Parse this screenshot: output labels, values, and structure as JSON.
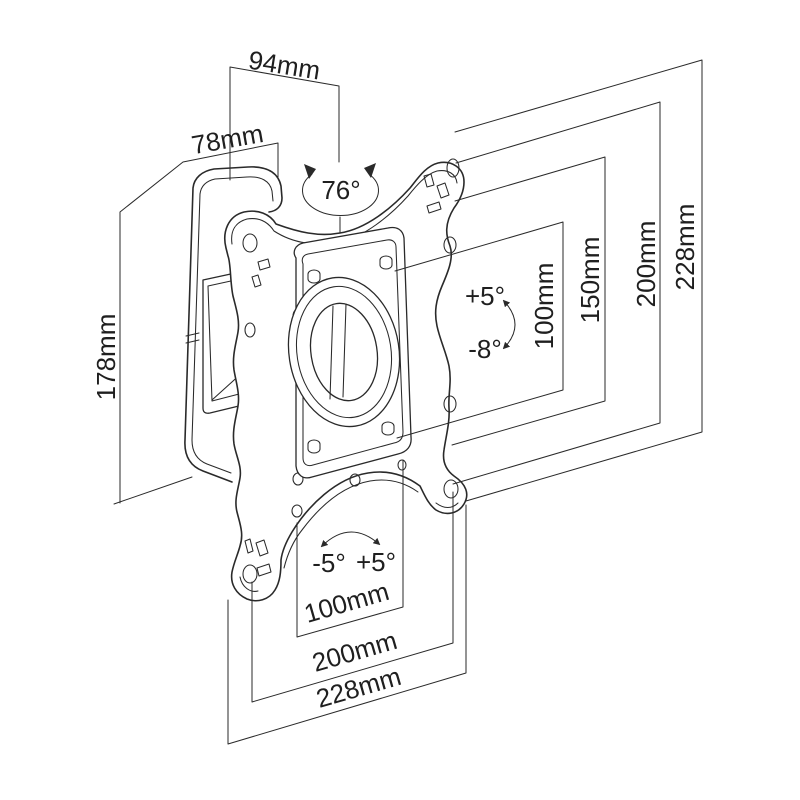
{
  "diagram": {
    "colors": {
      "ink": "#2a2a2a",
      "background": "#ffffff"
    },
    "dims": {
      "depth": "94mm",
      "wall_plate_width": "78mm",
      "swivel_range": "76°",
      "wall_plate_height": "178mm",
      "tilt_up": "+5°",
      "tilt_down": "-8°",
      "right": [
        "100mm",
        "150mm",
        "200mm",
        "228mm"
      ],
      "bottom": [
        "100mm",
        "200mm",
        "228mm"
      ],
      "base_swivel_left": "-5°",
      "base_swivel_right": "+5°"
    }
  }
}
